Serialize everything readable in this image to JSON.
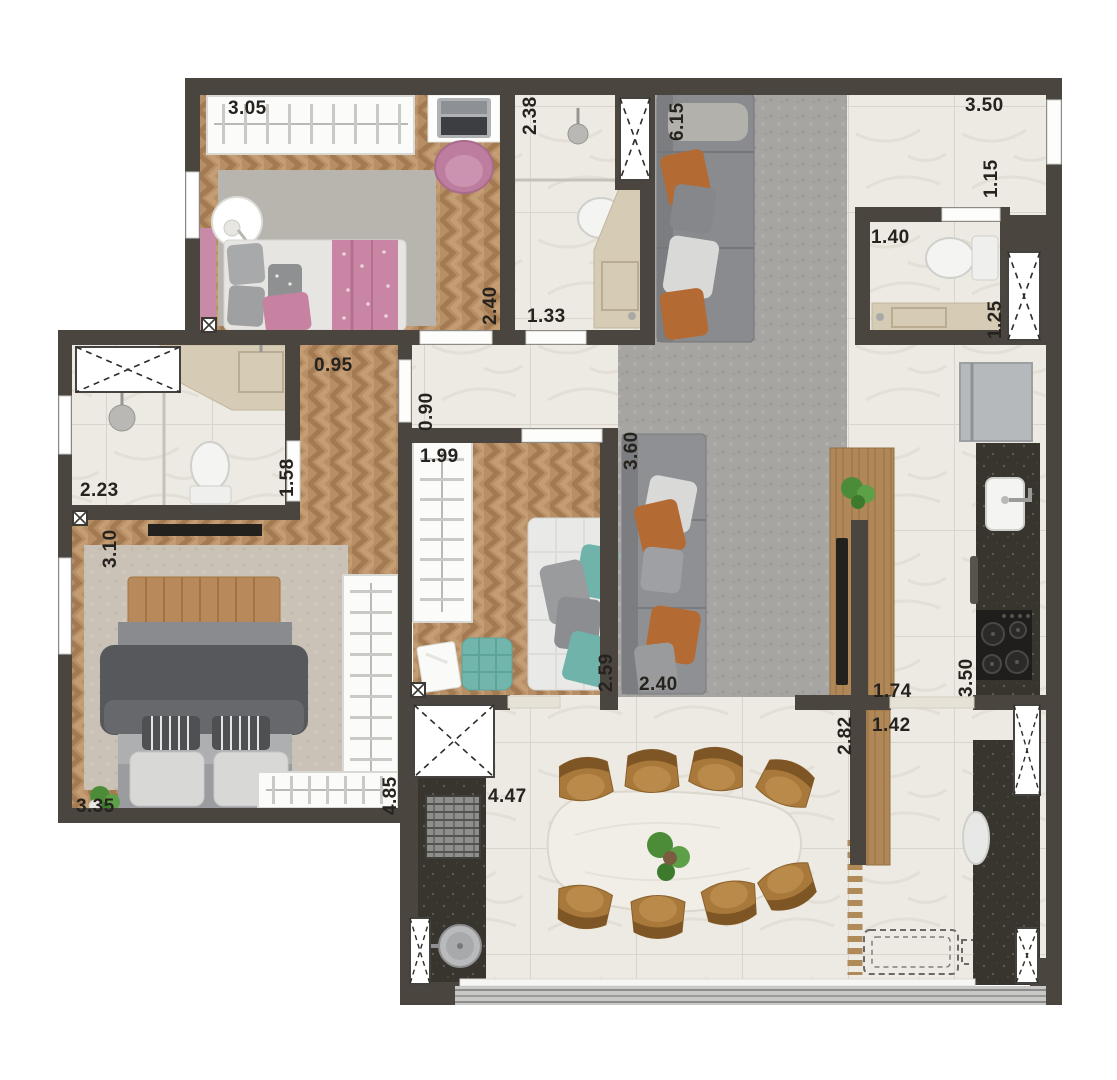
{
  "plan": {
    "type": "apartment-floor-plan",
    "unit": "m",
    "palette": {
      "wall": "#4a463f",
      "wood_floor": "#b78f66",
      "tile_floor": "#edeae3",
      "rug_gray": "#a7a5a2",
      "rug_beige": "#cac2b6",
      "granite": "#38352f",
      "wood_counter": "#b08756",
      "accent_pink": "#c783a2",
      "accent_teal": "#6fb3ab",
      "accent_orange": "#b46a33",
      "chair_leather": "#a8793a",
      "plant_green": "#4c8c38",
      "label_text": "#26231f"
    },
    "dims": {
      "bedroom1_closet": "3.05",
      "bedroom1_width": "2.40",
      "bath1_length": "2.38",
      "bath1_width": "1.33",
      "living_sofa_wall": "6.15",
      "entry_width": "3.50",
      "entry_passage": "1.15",
      "service_bath_width": "1.40",
      "service_bath_vanity": "1.25",
      "bath2_width": "2.23",
      "bath2_length": "1.58",
      "hall_width": "0.95",
      "hall_passage": "0.90",
      "master_width_upper": "3.10",
      "master_width_lower": "3.35",
      "master_length": "4.85",
      "office_closet": "1.99",
      "office_sofa": "2.59",
      "living_sofa": "2.40",
      "living_width": "3.60",
      "counter_upper": "1.74",
      "counter_lower": "1.42",
      "kitchen_counter": "3.50",
      "balcony_depth": "2.82",
      "balcony_width": "4.47"
    }
  }
}
